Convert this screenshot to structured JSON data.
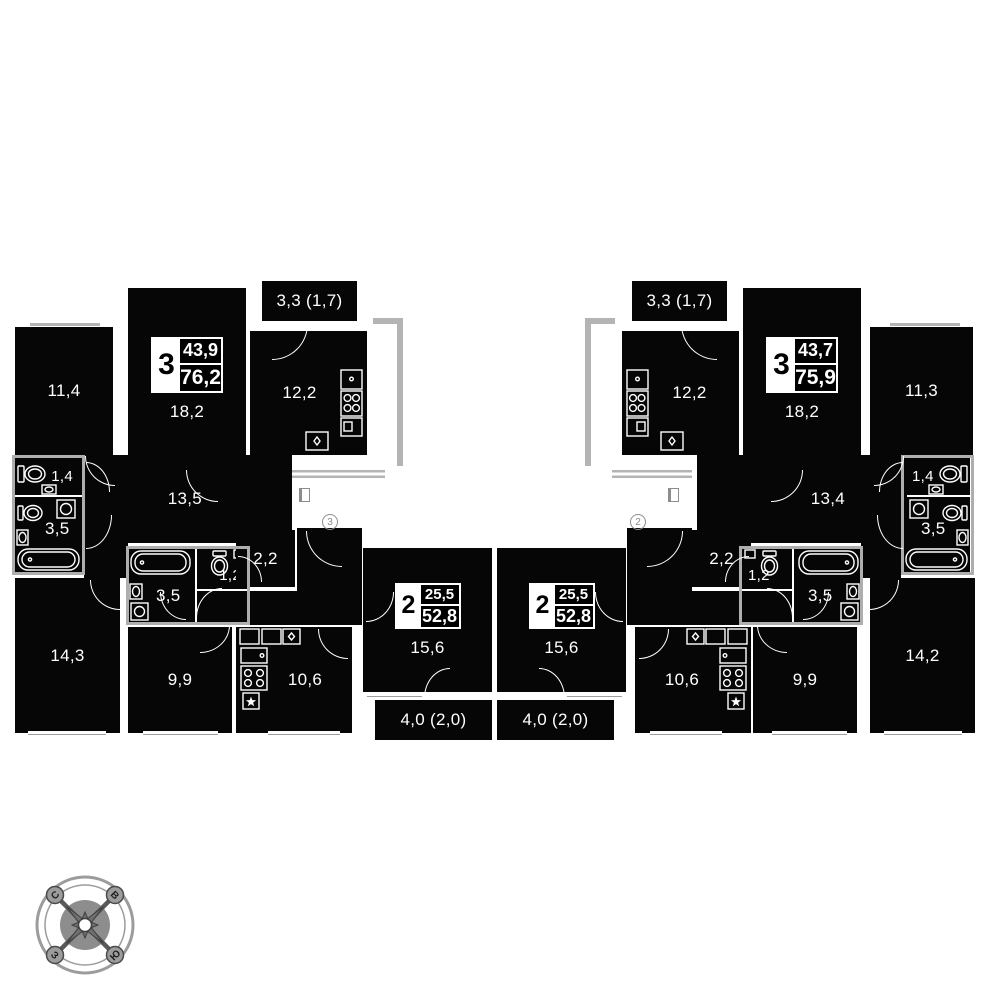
{
  "plates": {
    "left3": {
      "rooms": "3",
      "living": "43,9",
      "total": "76,2"
    },
    "right3": {
      "rooms": "3",
      "living": "43,7",
      "total": "75,9"
    },
    "left2": {
      "rooms": "2",
      "living": "25,5",
      "total": "52,8"
    },
    "right2": {
      "rooms": "2",
      "living": "25,5",
      "total": "52,8"
    }
  },
  "rooms": {
    "l_bedroom1": "11,4",
    "l_living": "18,2",
    "l_balcony": "3,3 (1,7)",
    "l_kitchen": "12,2",
    "l_wc": "1,4",
    "l_bath": "3,5",
    "l_hall": "13,5",
    "l_bedroom2": "14,3",
    "l2_bath": "3,5",
    "l2_wc": "1,2",
    "l2_ward": "2,2",
    "l2_hall": "7,8",
    "l2_bedroom": "9,9",
    "l2_kitchen": "10,6",
    "l2_living": "15,6",
    "l2_balcony": "4,0 (2,0)",
    "r_balcony": "3,3 (1,7)",
    "r_kitchen": "12,2",
    "r_living": "18,2",
    "r_bedroom1": "11,3",
    "r_wc": "1,4",
    "r_bath": "3,5",
    "r_hall": "13,4",
    "r_bedroom2": "14,2",
    "r2_ward": "2,2",
    "r2_wc": "1,2",
    "r2_bath": "3,5",
    "r2_hall": "7,8",
    "r2_kitchen": "10,6",
    "r2_bedroom": "9,9",
    "r2_living": "15,6",
    "r2_balcony": "4,0 (2,0)"
  },
  "landing": {
    "left_number": "3",
    "right_number": "2"
  },
  "compass": {
    "n": "С",
    "e": "В",
    "s": "Ю",
    "w": "З"
  }
}
